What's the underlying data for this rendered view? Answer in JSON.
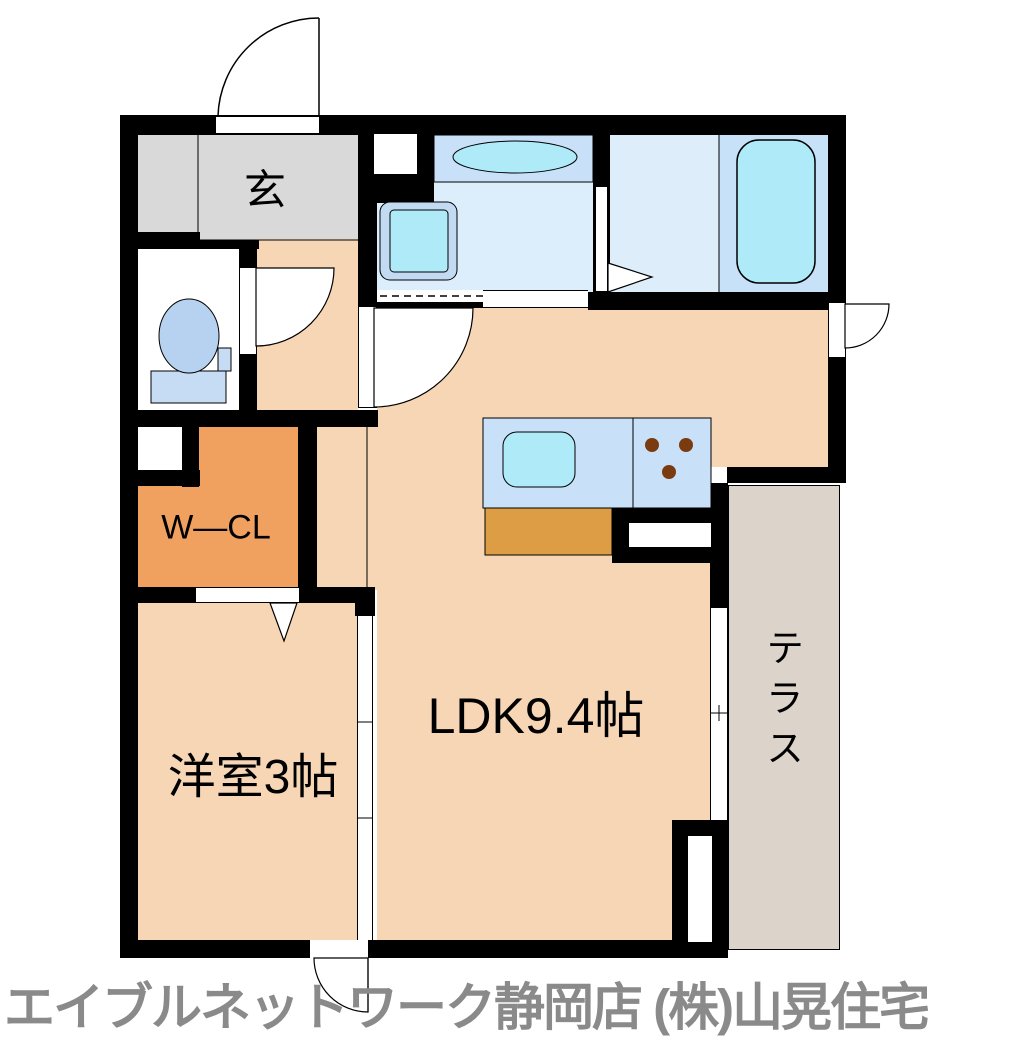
{
  "rooms": {
    "entrance": {
      "label": "玄"
    },
    "walk_in_closet": {
      "label": "W—CL"
    },
    "western_room": {
      "label": "洋室3帖"
    },
    "ldk": {
      "label": "LDK9.4帖"
    },
    "terrace": {
      "label": "テラス"
    }
  },
  "footer": {
    "agency_text": "エイブルネットワーク静岡店 (株)山晃住宅"
  },
  "fixtures": {
    "bathtub": "bathtub",
    "toilet": "toilet",
    "vanity": "vanity-counter-with-basin",
    "washer_pan": "washing-machine-pan",
    "kitchen": "kitchen-counter-with-sink-and-stove",
    "doors": "hinged-doors-sliding-doors-folding-doors"
  },
  "colors": {
    "wall": "#000000",
    "room_peach": "#F6D6B5",
    "entrance_gray": "#D9D9D9",
    "washroom_blue": "#DCEDFB",
    "bath_blue": "#DDEEFA",
    "tubroom_blue": "#C7E1F8",
    "counter_blue": "#C8E0F8",
    "fixture_cyan": "#AEEAF8",
    "pan_blue": "#C3DAF3",
    "tank_blue": "#C6DCF5",
    "bowl_blue": "#B7D2F1",
    "wcl_orange": "#F0A160",
    "cabinet_orange": "#DD9D45",
    "terrace_gray": "#DCD4CB",
    "burner_brown": "#7A3B10",
    "footer_gray": "#8A8A8A"
  }
}
